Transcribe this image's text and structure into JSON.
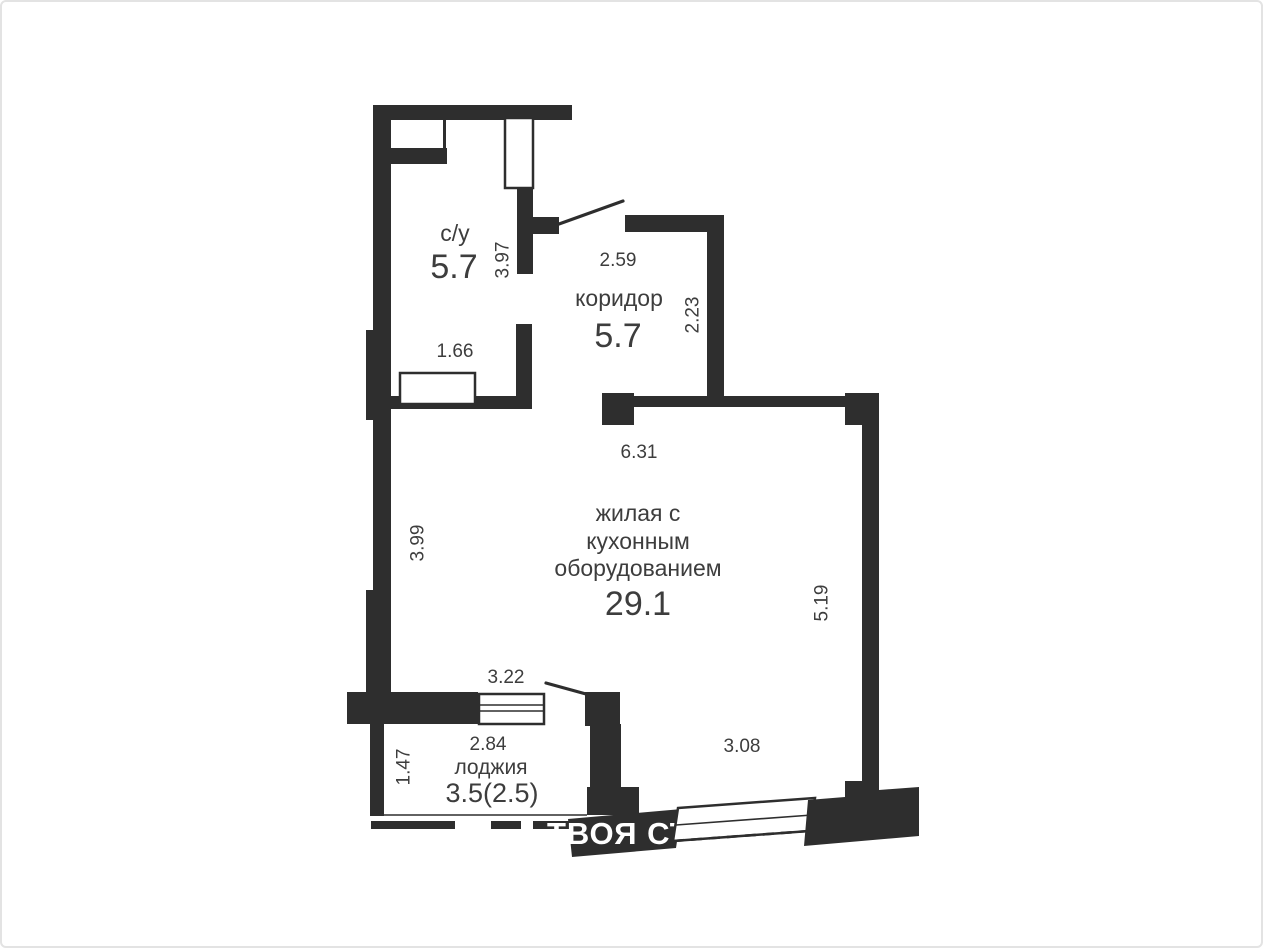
{
  "colors": {
    "wall": "#2e2e2e",
    "label_text": "#3d3d3d",
    "background": "#ffffff",
    "frame": "#e3e3e3",
    "watermark": "#ffffff"
  },
  "watermark": {
    "text": "ТВОЯ СТОЛИЦА"
  },
  "rooms": {
    "bathroom": {
      "name": "с/у",
      "area": "5.7"
    },
    "corridor": {
      "name": "коридор",
      "area": "5.7"
    },
    "living": {
      "name_line1": "жилая с",
      "name_line2": "кухонным",
      "name_line3": "оборудованием",
      "area": "29.1"
    },
    "loggia": {
      "name": "лоджия",
      "area": "3.5(2.5)"
    }
  },
  "dims": {
    "bathroom_height": "3.97",
    "bathroom_opening": "1.66",
    "corridor_width": "2.59",
    "corridor_depth": "2.23",
    "living_width": "6.31",
    "living_left_height": "3.99",
    "living_right_height": "5.19",
    "living_bottom_width": "3.08",
    "loggia_opening_width": "3.22",
    "loggia_width": "2.84",
    "loggia_depth": "1.47"
  }
}
